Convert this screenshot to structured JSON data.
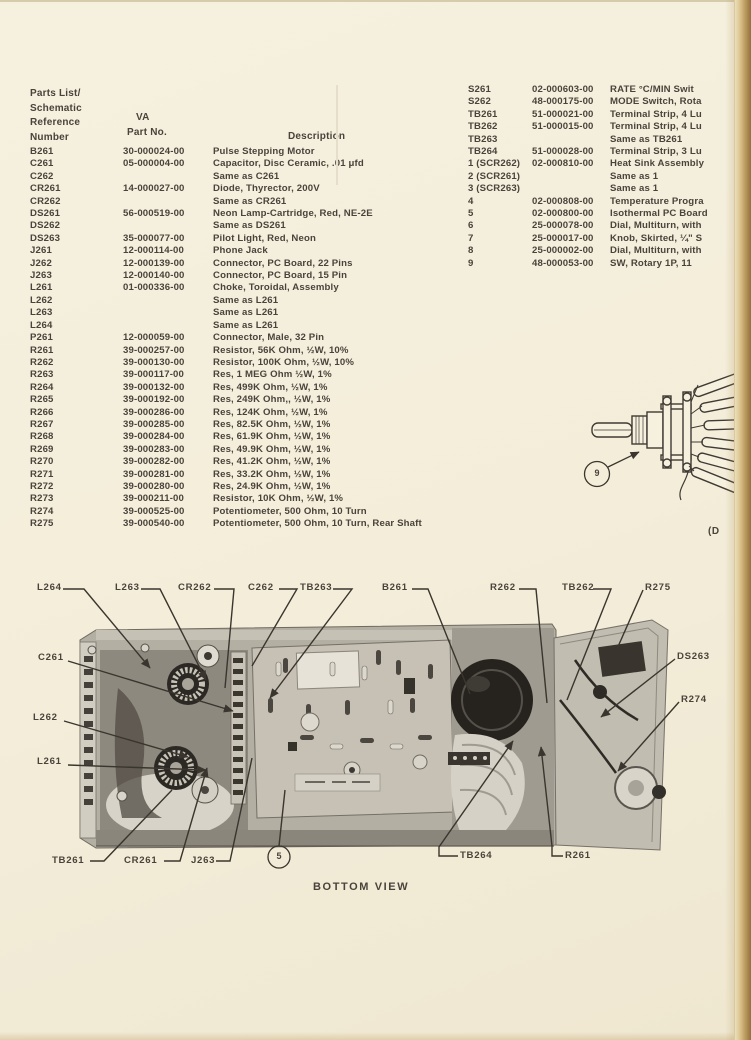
{
  "document": {
    "caption": "BOTTOM VIEW",
    "margin_note": "(D",
    "colors": {
      "paper": "#f3edda",
      "ink": "#4a433b",
      "book_edge": "#bb9a5c",
      "photo_dark": "#26231f",
      "photo_light": "#d7d3c8"
    }
  },
  "table": {
    "header": {
      "ref_line1": "Parts List/",
      "ref_line2": "Schematic",
      "ref_line3": "Reference",
      "ref_line4": "Number",
      "va": "VA",
      "part_no": "Part No.",
      "description": "Description"
    },
    "left_rows": [
      {
        "ref": "B261",
        "part": "30-000024-00",
        "desc": "Pulse Stepping Motor"
      },
      {
        "ref": "C261",
        "part": "05-000004-00",
        "desc": "Capacitor, Disc Ceramic, .01 μfd"
      },
      {
        "ref": "C262",
        "part": "",
        "desc": "Same as C261"
      },
      {
        "ref": "CR261",
        "part": "14-000027-00",
        "desc": "Diode, Thyrector, 200V"
      },
      {
        "ref": "CR262",
        "part": "",
        "desc": "Same as CR261"
      },
      {
        "ref": "DS261",
        "part": "56-000519-00",
        "desc": "Neon Lamp-Cartridge, Red, NE-2E"
      },
      {
        "ref": "DS262",
        "part": "",
        "desc": "Same as DS261"
      },
      {
        "ref": "DS263",
        "part": "35-000077-00",
        "desc": "Pilot Light, Red, Neon"
      },
      {
        "ref": "J261",
        "part": "12-000114-00",
        "desc": "Phone Jack"
      },
      {
        "ref": "J262",
        "part": "12-000139-00",
        "desc": "Connector, PC Board, 22 Pins"
      },
      {
        "ref": "J263",
        "part": "12-000140-00",
        "desc": "Connector, PC Board, 15 Pin"
      },
      {
        "ref": "L261",
        "part": "01-000336-00",
        "desc": "Choke, Toroidal, Assembly"
      },
      {
        "ref": "L262",
        "part": "",
        "desc": "Same as L261"
      },
      {
        "ref": "L263",
        "part": "",
        "desc": "Same as L261"
      },
      {
        "ref": "L264",
        "part": "",
        "desc": "Same as L261"
      },
      {
        "ref": "P261",
        "part": "12-000059-00",
        "desc": "Connector, Male, 32 Pin"
      },
      {
        "ref": "R261",
        "part": "39-000257-00",
        "desc": "Resistor, 56K Ohm, ½W, 10%"
      },
      {
        "ref": "R262",
        "part": "39-000130-00",
        "desc": "Resistor, 100K Ohm, ½W, 10%"
      },
      {
        "ref": "R263",
        "part": "39-000117-00",
        "desc": "Res, 1 MEG Ohm ½W, 1%"
      },
      {
        "ref": "R264",
        "part": "39-000132-00",
        "desc": "Res, 499K Ohm, ½W, 1%"
      },
      {
        "ref": "R265",
        "part": "39-000192-00",
        "desc": "Res, 249K Ohm,, ½W, 1%"
      },
      {
        "ref": "R266",
        "part": "39-000286-00",
        "desc": "Res, 124K Ohm, ½W, 1%"
      },
      {
        "ref": "R267",
        "part": "39-000285-00",
        "desc": "Res, 82.5K Ohm, ½W, 1%"
      },
      {
        "ref": "R268",
        "part": "39-000284-00",
        "desc": "Res, 61.9K Ohm, ½W, 1%"
      },
      {
        "ref": "R269",
        "part": "39-000283-00",
        "desc": "Res, 49.9K Ohm, ½W, 1%"
      },
      {
        "ref": "R270",
        "part": "39-000282-00",
        "desc": "Res, 41.2K Ohm, ½W, 1%"
      },
      {
        "ref": "R271",
        "part": "39-000281-00",
        "desc": "Res, 33.2K Ohm, ½W, 1%"
      },
      {
        "ref": "R272",
        "part": "39-000280-00",
        "desc": "Res, 24.9K Ohm, ½W, 1%"
      },
      {
        "ref": "R273",
        "part": "39-000211-00",
        "desc": "Resistor, 10K Ohm, ½W, 1%"
      },
      {
        "ref": "R274",
        "part": "39-000525-00",
        "desc": "Potentiometer, 500 Ohm, 10 Turn"
      },
      {
        "ref": "R275",
        "part": "39-000540-00",
        "desc": "Potentiometer, 500 Ohm, 10 Turn, Rear Shaft"
      }
    ],
    "right_rows": [
      {
        "ref": "S261",
        "part": "02-000603-00",
        "desc": "RATE °C/MIN Swit"
      },
      {
        "ref": "S262",
        "part": "48-000175-00",
        "desc": "MODE Switch, Rota"
      },
      {
        "ref": "TB261",
        "part": "51-000021-00",
        "desc": "Terminal Strip, 4 Lu"
      },
      {
        "ref": "TB262",
        "part": "51-000015-00",
        "desc": "Terminal Strip, 4 Lu"
      },
      {
        "ref": "TB263",
        "part": "",
        "desc": "Same as TB261"
      },
      {
        "ref": "TB264",
        "part": "51-000028-00",
        "desc": "Terminal Strip, 3 Lu"
      },
      {
        "ref": "1 (SCR262)",
        "part": "02-000810-00",
        "desc": "Heat Sink Assembly"
      },
      {
        "ref": "2 (SCR261)",
        "part": "",
        "desc": "Same as 1"
      },
      {
        "ref": "3 (SCR263)",
        "part": "",
        "desc": "Same as 1"
      },
      {
        "ref": "4",
        "part": "02-000808-00",
        "desc": "Temperature Progra"
      },
      {
        "ref": "5",
        "part": "02-000800-00",
        "desc": "Isothermal PC Board"
      },
      {
        "ref": "6",
        "part": "25-000078-00",
        "desc": "Dial, Multiturn, with"
      },
      {
        "ref": "7",
        "part": "25-000017-00",
        "desc": "Knob, Skirted, ¼\" S"
      },
      {
        "ref": "8",
        "part": "25-000002-00",
        "desc": "Dial, Multiturn, with"
      },
      {
        "ref": "9",
        "part": "48-000053-00",
        "desc": "SW, Rotary  1P, 11 "
      }
    ]
  },
  "figure": {
    "labels": {
      "l264": "L264",
      "l263": "L263",
      "cr262": "CR262",
      "c262": "C262",
      "tb263": "TB263",
      "b261": "B261",
      "r262": "R262",
      "tb262": "TB262",
      "r275": "R275",
      "c261": "C261",
      "l262": "L262",
      "l261": "L261",
      "tb261": "TB261",
      "cr261": "CR261",
      "j263": "J263",
      "tb264": "TB264",
      "r261": "R261",
      "ds263": "DS263",
      "r274": "R274"
    },
    "callout_5": "5",
    "callout_9": "9"
  }
}
